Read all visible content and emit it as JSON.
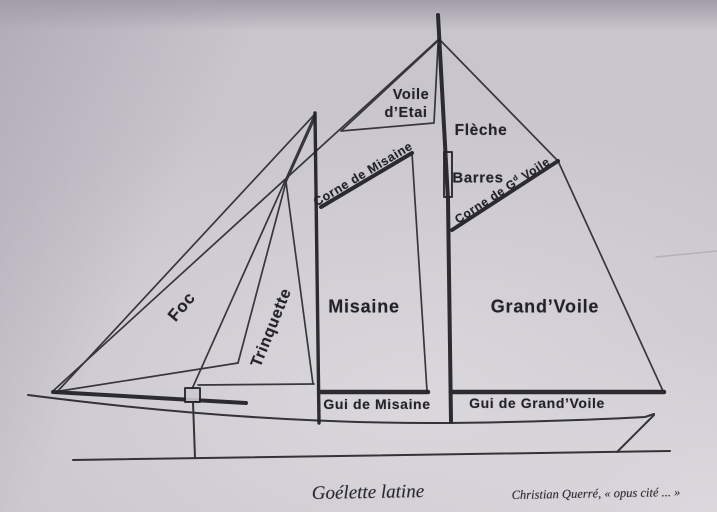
{
  "diagram": {
    "title_caption": "Goélette latine",
    "credit": "Christian Querré, « opus cité ... »",
    "sail_labels": {
      "voile_etai_line1": "Voile",
      "voile_etai_line2": "d’Etai",
      "fleche": "Flèche",
      "misaine": "Misaine",
      "grand_voile": "Grand’Voile",
      "foc": "Foc",
      "trinquette": "Trinquette"
    },
    "spar_labels": {
      "barres": "Barres",
      "corne_misaine": "Corne de Misaine",
      "corne_grand_voile_prefix": "Corne de G",
      "corne_grand_voile_sup": "d",
      "corne_grand_voile_suffix": " Voile",
      "gui_misaine": "Gui de Misaine",
      "gui_grand_voile": "Gui de Grand’Voile"
    },
    "colors": {
      "paper": "#c9c5cd",
      "ink": "#232327",
      "crease": "#b6b2bb"
    }
  }
}
